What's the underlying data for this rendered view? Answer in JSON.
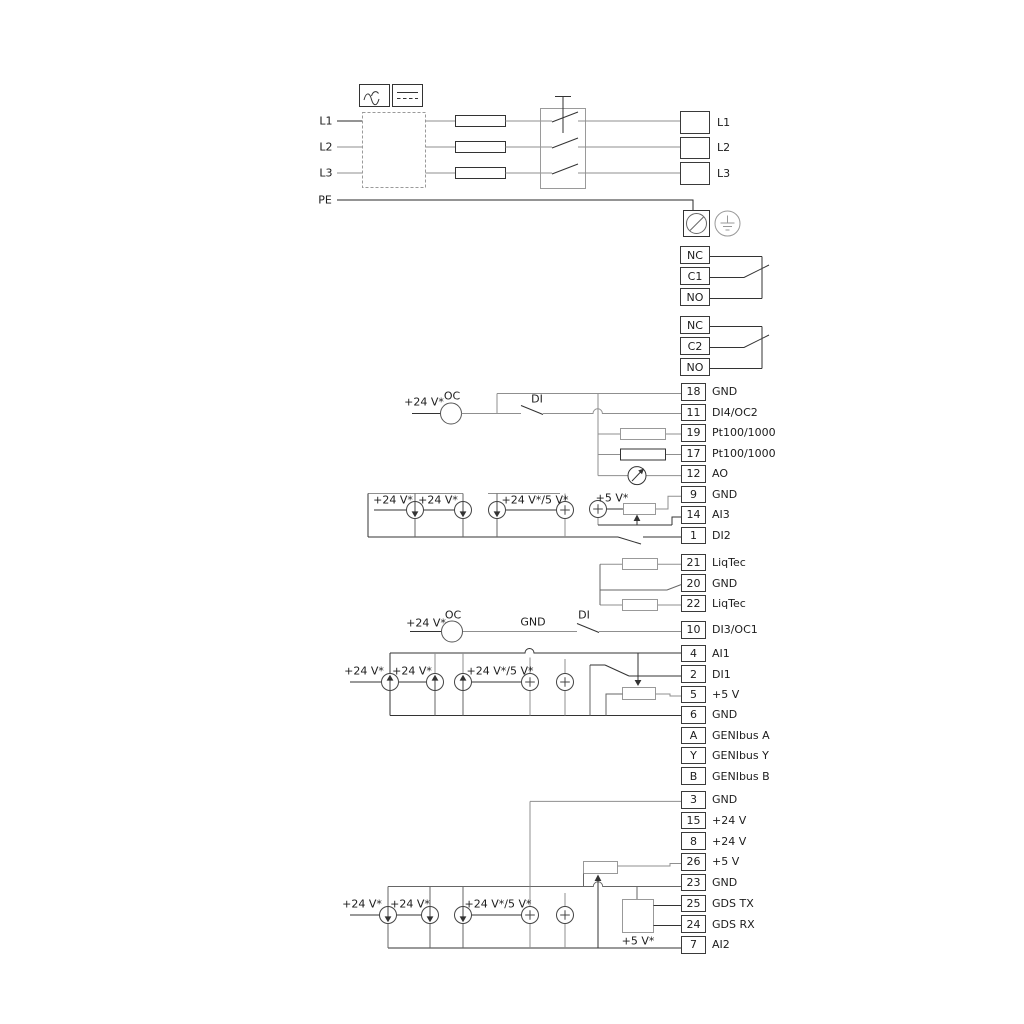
{
  "diagram": {
    "mains_inputs": {
      "l1": "L1",
      "l2": "L2",
      "l3": "L3",
      "pe": "PE"
    },
    "mains_output": [
      {
        "num": "",
        "label": "L1"
      },
      {
        "num": "",
        "label": "L2"
      },
      {
        "num": "",
        "label": "L3"
      }
    ],
    "relay_1": [
      {
        "num": "NC",
        "label": ""
      },
      {
        "num": "C1",
        "label": ""
      },
      {
        "num": "NO",
        "label": ""
      }
    ],
    "relay_2": [
      {
        "num": "NC",
        "label": ""
      },
      {
        "num": "C2",
        "label": ""
      },
      {
        "num": "NO",
        "label": ""
      }
    ],
    "io_strip_top": [
      {
        "num": "18",
        "label": "GND"
      },
      {
        "num": "11",
        "label": "DI4/OC2"
      },
      {
        "num": "19",
        "label": "Pt100/1000"
      },
      {
        "num": "17",
        "label": "Pt100/1000"
      },
      {
        "num": "12",
        "label": "AO"
      },
      {
        "num": "9",
        "label": "GND"
      },
      {
        "num": "14",
        "label": "AI3"
      },
      {
        "num": "1",
        "label": "DI2"
      }
    ],
    "liqtec_strip": [
      {
        "num": "21",
        "label": "LiqTec"
      },
      {
        "num": "20",
        "label": "GND"
      },
      {
        "num": "22",
        "label": "LiqTec"
      }
    ],
    "di3_strip": [
      {
        "num": "10",
        "label": "DI3/OC1"
      }
    ],
    "io_strip_mid": [
      {
        "num": "4",
        "label": "AI1"
      },
      {
        "num": "2",
        "label": "DI1"
      },
      {
        "num": "5",
        "label": "+5 V"
      },
      {
        "num": "6",
        "label": "GND"
      },
      {
        "num": "A",
        "label": "GENIbus A"
      },
      {
        "num": "Y",
        "label": "GENIbus Y"
      },
      {
        "num": "B",
        "label": "GENIbus B"
      }
    ],
    "io_strip_bottom": [
      {
        "num": "3",
        "label": "GND"
      },
      {
        "num": "15",
        "label": "+24 V"
      },
      {
        "num": "8",
        "label": "+24 V"
      },
      {
        "num": "26",
        "label": "+5 V"
      },
      {
        "num": "23",
        "label": "GND"
      },
      {
        "num": "25",
        "label": "GDS TX"
      },
      {
        "num": "24",
        "label": "GDS RX"
      },
      {
        "num": "7",
        "label": "AI2"
      }
    ],
    "labels": {
      "plus24v": "+24 V*",
      "plus24v_5v": "+24 V*/5 V*",
      "plus5v": "+5 V*",
      "oc": "OC",
      "di": "DI",
      "gnd": "GND"
    }
  }
}
